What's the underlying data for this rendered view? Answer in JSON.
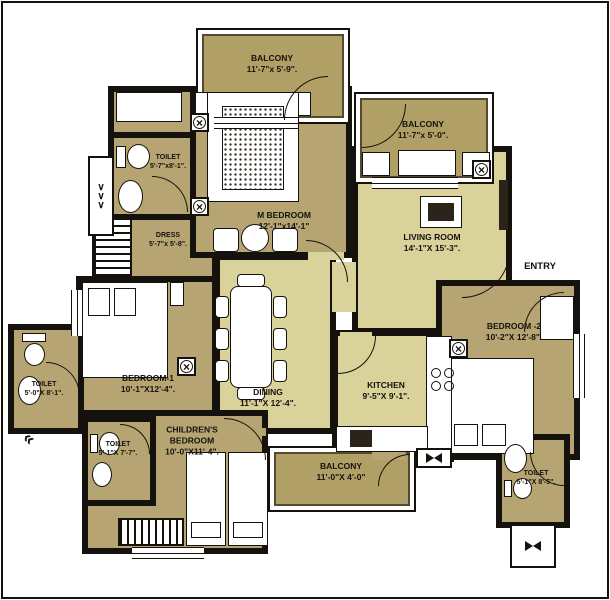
{
  "plan": {
    "entry_label": "ENTRY",
    "rooms": {
      "balcony_top": {
        "name": "BALCONY",
        "dims": "11'-7\"x 5'-9\"."
      },
      "balcony_right": {
        "name": "BALCONY",
        "dims": "11'-7\"x 5'-0\"."
      },
      "m_bedroom": {
        "name": "M BEDROOM",
        "dims": "12'-1\"x14'-1\""
      },
      "toilet_master": {
        "name": "TOILET",
        "dims": "5'-7\"x8'-1\"."
      },
      "dress": {
        "name": "DRESS",
        "dims": "5'-7\"x 5'-8\"."
      },
      "living": {
        "name": "LIVING ROOM",
        "dims": "14'-1\"X 15'-3\"."
      },
      "bedroom1": {
        "name": "BEDROOM-1",
        "dims": "10'-1\"X12'-4\"."
      },
      "dining": {
        "name": "DINING",
        "dims": "11'-1\"X 12'-4\"."
      },
      "kitchen": {
        "name": "KITCHEN",
        "dims": "9'-5\"X 9'-1\"."
      },
      "bedroom2": {
        "name": "BEDROOM -2",
        "dims": "10'-2\"X 12'-8\"."
      },
      "children": {
        "name": "CHILDREN'S BEDROOM",
        "dims": "10'-0\"X11'-4\"."
      },
      "balcony_bottom": {
        "name": "BALCONY",
        "dims": "11'-0\"X 4'-0\""
      },
      "toilet_left": {
        "name": "TOILET",
        "dims": "5'-0\"X 8'-1\"."
      },
      "toilet_children": {
        "name": "TOILET",
        "dims": "5'-1\"X 7'-7\"."
      },
      "toilet_br": {
        "name": "TOILET",
        "dims": "5'-1\"X 8'-5\"."
      }
    },
    "colors": {
      "wall": "#15120e",
      "bedroom_fill": "#b6a572",
      "balcony_fill": "#b1a066",
      "living_fill": "#d9d29a",
      "background": "#ffffff"
    }
  }
}
